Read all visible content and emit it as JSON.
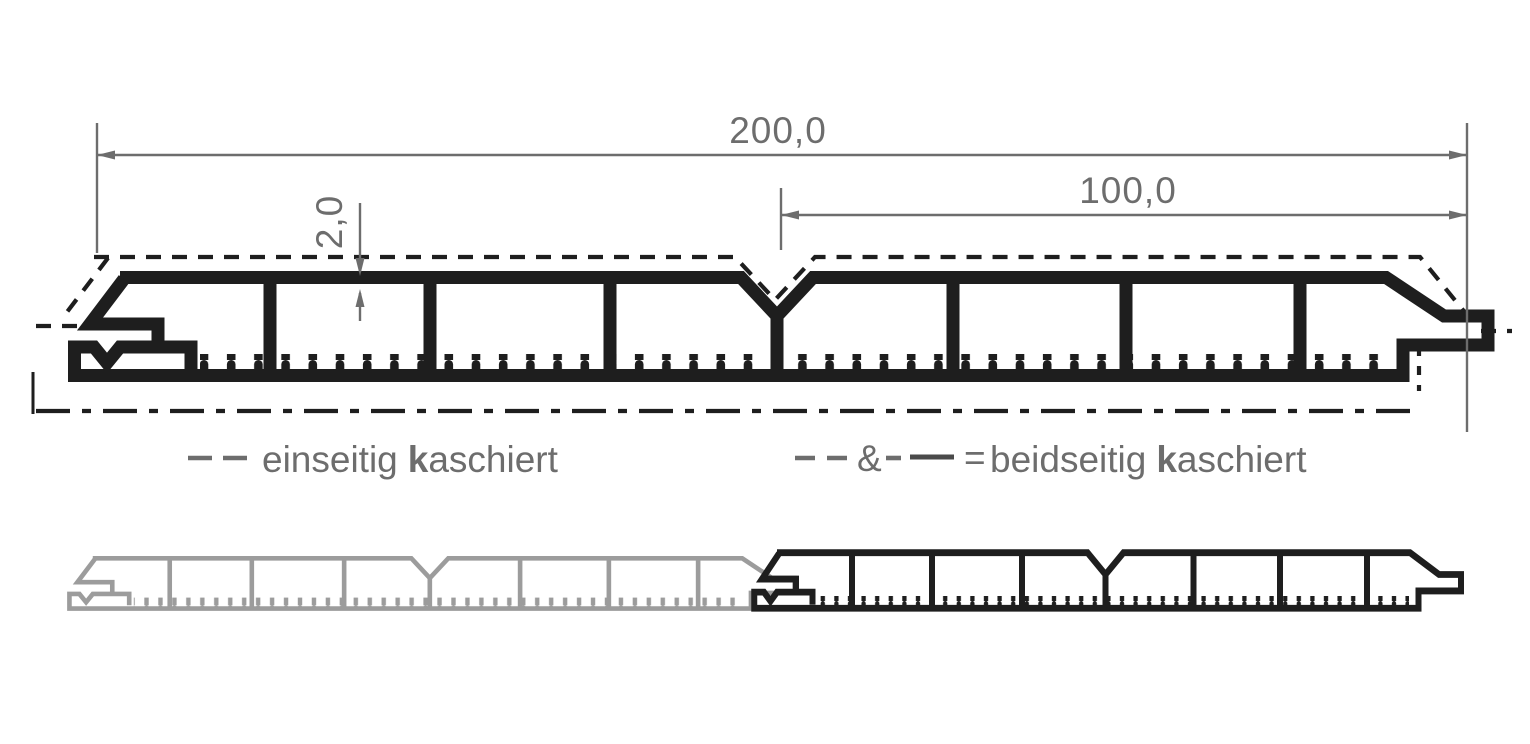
{
  "dimensions": {
    "total": "200,0",
    "half": "100,0",
    "thickness": "2,0"
  },
  "legend": {
    "left": {
      "word1": "einseitig",
      "bold": "k",
      "rest": "aschiert"
    },
    "right": {
      "amp": "&",
      "equals": "=",
      "word1": "beidseitig",
      "bold": "k",
      "rest": "aschiert"
    }
  },
  "colors": {
    "ink": "#1e1e1e",
    "profile_gray": "#9c9c9c",
    "dimension_gray": "#6d6d6d",
    "background": "#ffffff"
  }
}
